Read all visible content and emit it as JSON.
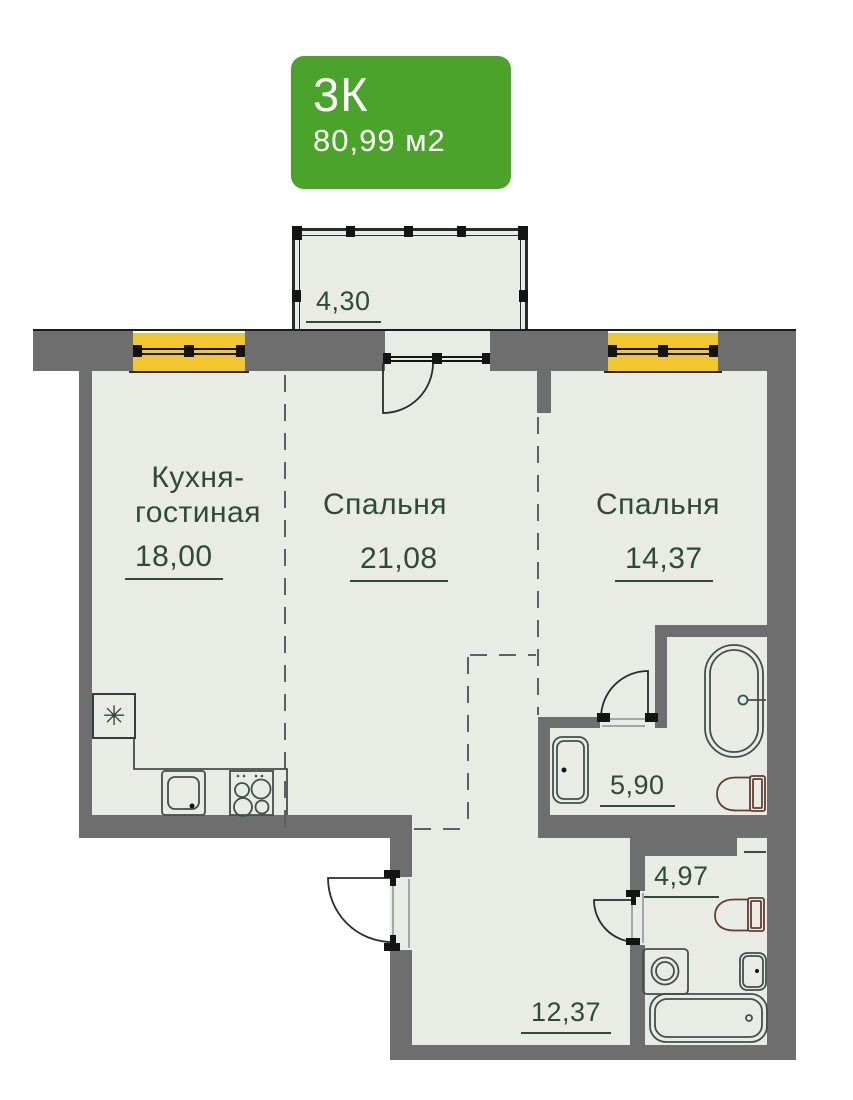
{
  "badge": {
    "type": "3К",
    "area": "80,99 м2"
  },
  "rooms": {
    "balcony": {
      "area": "4,30"
    },
    "kitchen_living": {
      "name_line1": "Кухня-",
      "name_line2": "гостиная",
      "area": "18,00"
    },
    "bedroom_1": {
      "name": "Спальня",
      "area": "21,08"
    },
    "bedroom_2": {
      "name": "Спальня",
      "area": "14,37"
    },
    "bathroom_1": {
      "area": "5,90"
    },
    "bathroom_2": {
      "area": "4,97"
    },
    "hallway": {
      "area": "12,37"
    }
  },
  "symbols": {
    "vent_shaft": "✳"
  },
  "colors": {
    "badge_green": "#4ba32b",
    "wall_gray": "#6e6e6e",
    "floor": "#e9ebe5",
    "window_yellow": "#f2c62d",
    "label_green": "#2d4a3a",
    "toilet_outline": "#643c34"
  }
}
